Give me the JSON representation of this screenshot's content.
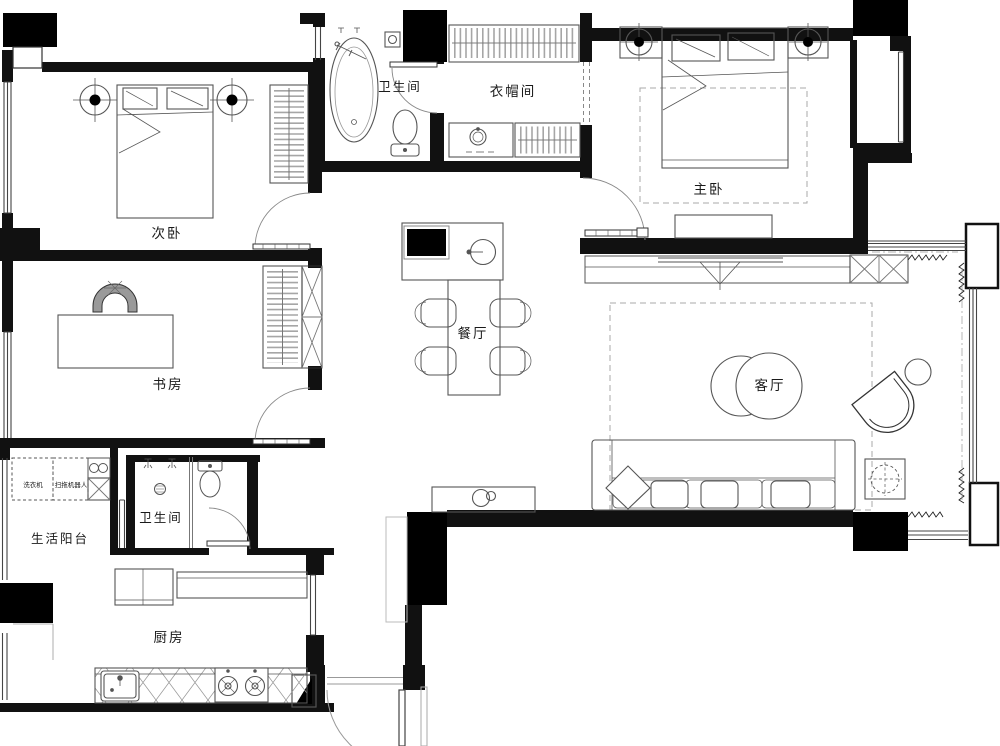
{
  "plan": {
    "title": "apartment-floor-plan",
    "rooms": {
      "secondary_bedroom": "次卧",
      "study": "书房",
      "service_balcony": "生活阳台",
      "bathroom_lower": "卫生间",
      "kitchen": "厨房",
      "bathroom_upper": "卫生间",
      "cloakroom": "衣帽间",
      "master_bedroom": "主卧",
      "dining_room": "餐厅",
      "living_room": "客厅"
    },
    "appliances": {
      "washing_machine": "洗衣机",
      "robot_vacuum": "扫拖机器人"
    },
    "colors": {
      "wall": "#111111",
      "column_fill": "#000000",
      "furniture_line": "#555555",
      "light_line": "#999999",
      "hatch": "#8a8a8a",
      "background": "#ffffff"
    }
  }
}
